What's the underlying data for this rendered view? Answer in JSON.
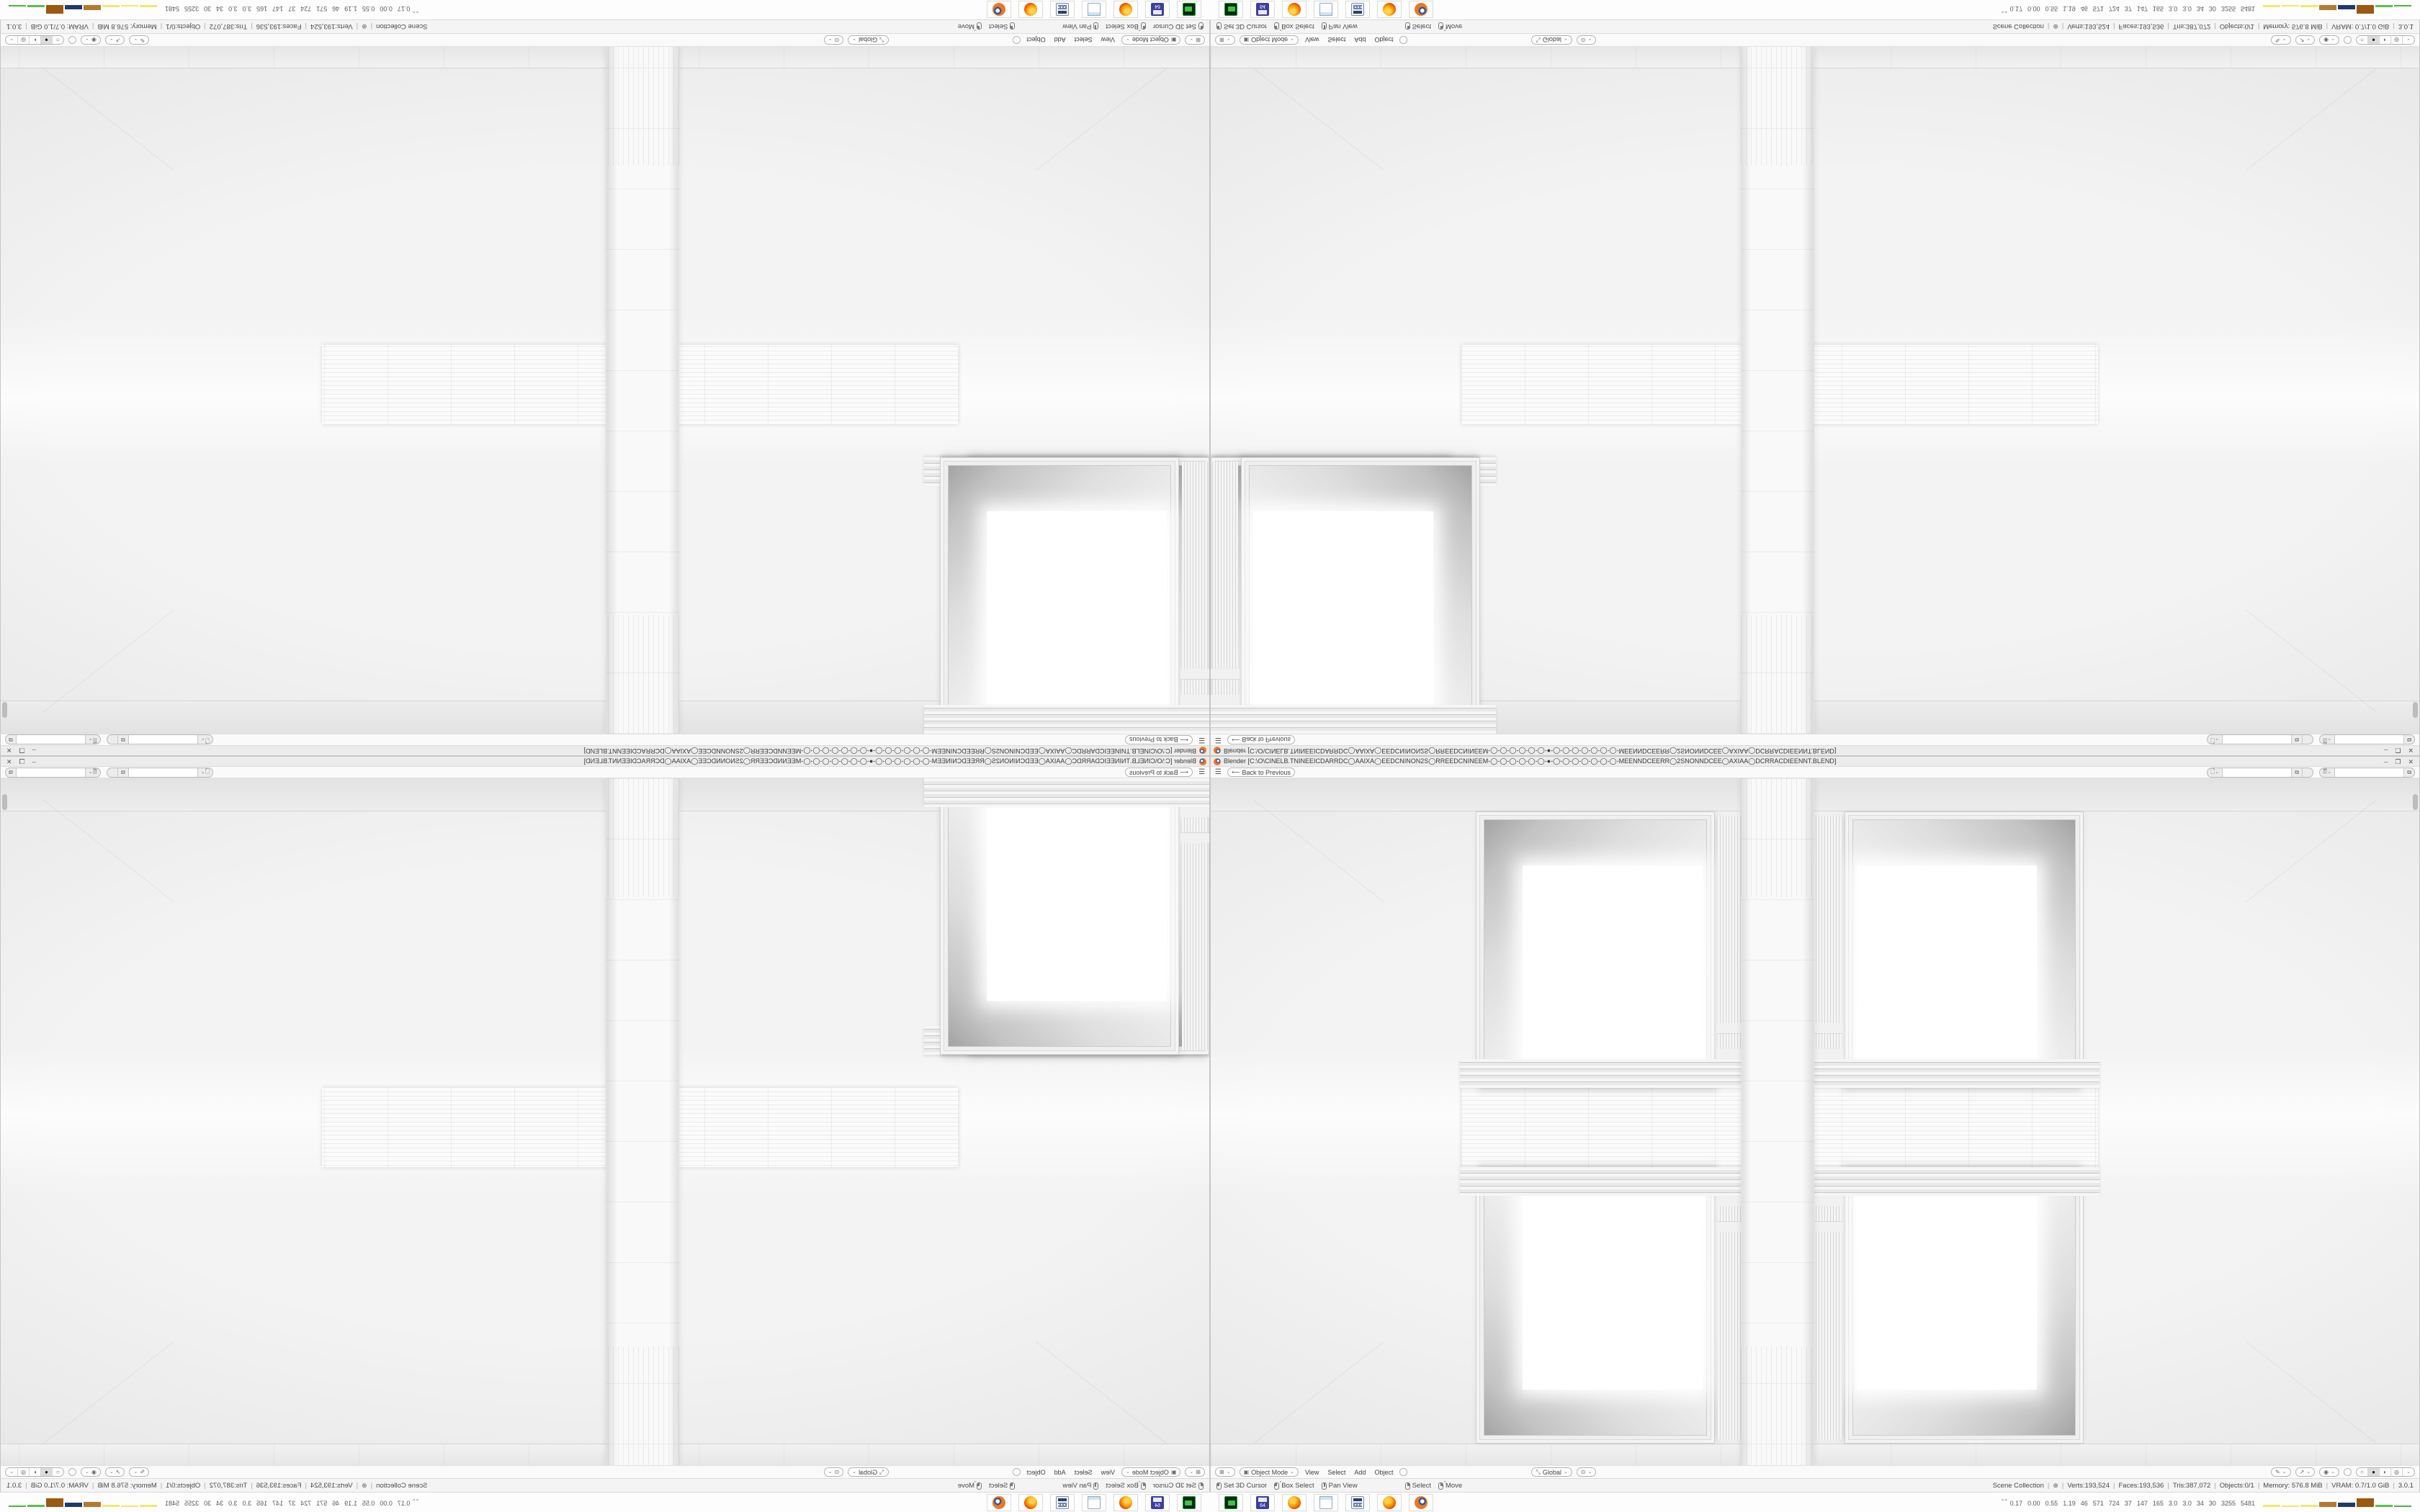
{
  "window": {
    "title": "Blender [C:\\O\\CINELB.TNINEEICDARRDC◯AAIXA◯EEDCNINON2S◯RREEDCNINEEM-◯-◯-◯-◯-◯-◯-●-◯-◯-◯-◯-◯-◯-◯-MEENNDCEERR◯2SNONNDCEE◯AXIAA◯DCRRACDIEENNT.BLEND]",
    "controls": {
      "minimize": "–",
      "restore": "❐",
      "close": "✕"
    }
  },
  "topbar": {
    "menu_icon": "☰",
    "back_label": "Back to Previous",
    "scene_selector": {
      "icon": "scene-icon",
      "value": ""
    },
    "view_layer_selector": {
      "icon": "view-layer-icon",
      "value": ""
    }
  },
  "viewport": {
    "header": {
      "editor_type_icon": "⊞",
      "mode_icon": "▣",
      "mode": "Object Mode",
      "menus": [
        "View",
        "Select",
        "Add",
        "Object"
      ],
      "orientation": "Global",
      "orientation_icon": "⤡",
      "pivot_icon": "⊙",
      "gizmo_icon": "✎",
      "snap_icon": "↗",
      "proportional_icon": "◉",
      "shading_glyphs": [
        "○",
        "●",
        "◐",
        "◎"
      ],
      "active_shading": "solid"
    }
  },
  "status_bar": {
    "hints": [
      {
        "icon": "mouse-left",
        "label": "Set 3D Cursor"
      },
      {
        "icon": "mouse-left-drag",
        "label": "Box Select"
      },
      {
        "icon": "mouse-middle",
        "label": "Pan View"
      },
      {
        "icon": "mouse-right",
        "label": "Select"
      },
      {
        "icon": "mouse-right-drag",
        "label": "Move"
      }
    ],
    "scene_name": "Scene Collection",
    "globe_icon": "⊕",
    "stats": [
      "Verts:193,524",
      "Faces:193,536",
      "Tris:387,072",
      "Objects:0/1",
      "Memory: 576.8 MiB",
      "VRAM: 0.7/1.0 GiB",
      "3.0.1"
    ]
  },
  "taskbar": {
    "icons": [
      "gpu-z",
      "hwinfo64",
      "firefox",
      "notepad",
      "calculator",
      "firefox",
      "blender"
    ],
    "monitor": {
      "expander": "⌃⌃",
      "values": [
        "0.17",
        "0.00",
        "0.55",
        "1.19",
        "46",
        "571",
        "724",
        "37",
        "147",
        "165",
        "3.0",
        "3.0",
        "34",
        "30",
        "3255",
        "5481"
      ],
      "bars": [
        {
          "color": "#efe96a",
          "height": 3
        },
        {
          "color": "#efe96a",
          "height": 2
        },
        {
          "color": "#efe96a",
          "height": 3
        },
        {
          "color": "#b5792f",
          "height": 7
        },
        {
          "color": "#1f3a70",
          "height": 6
        },
        {
          "color": "#9a5a10",
          "height": 12
        },
        {
          "color": "#5abf4e",
          "height": 3
        },
        {
          "color": "#49b53e",
          "height": 2
        }
      ]
    }
  },
  "colors": {
    "blender_orange": "#f0771d",
    "chrome_bg": "#fafafa",
    "viewport_bg": "#ededed"
  }
}
